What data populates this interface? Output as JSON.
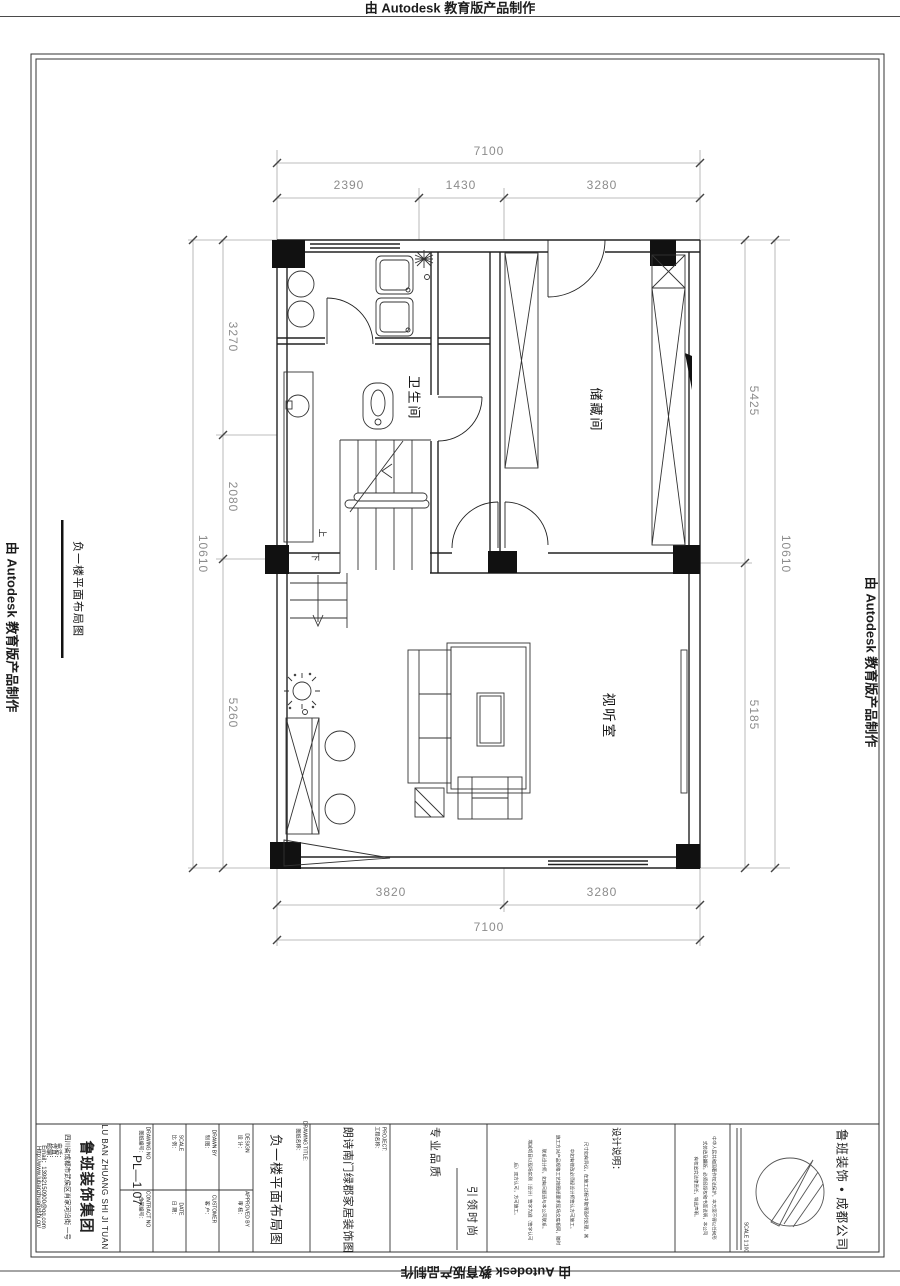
{
  "stamp": {
    "top": "由 Autodesk 教育版产品制作",
    "left": "由 Autodesk 教育版产品制作",
    "right": "由 Autodesk 教育版产品制作",
    "bottom": "由 Autodesk 教育版产品制作"
  },
  "plan": {
    "side_label": "负一楼平面布局图",
    "rooms": {
      "bathroom": "卫生间",
      "storage": "储藏间",
      "av": "视听室"
    },
    "stairs": {
      "up": "上",
      "down": "下"
    },
    "dims": {
      "top_total": "7100",
      "top_seg1": "2390",
      "top_seg2": "1430",
      "top_seg3": "3280",
      "left_seg1": "3270",
      "left_seg2": "2080",
      "left_seg3": "5260",
      "left_total": "10610",
      "right_seg1": "5425",
      "right_seg2": "5185",
      "right_total": "10610",
      "bottom_seg1": "3820",
      "bottom_seg2": "3280",
      "bottom_total": "7100"
    }
  },
  "titleblock": {
    "company_en": "LU BAN ZHUANG SHI JI TUAN",
    "company_cn": "鲁班装饰集团",
    "company_address": "四川省成都市武侯区肖家河沿街 一号",
    "contact_phone": "电话：",
    "contact_fax": "传真：",
    "contact_zip": "邮编：",
    "contact_email": "Email：13982150900@qq.com",
    "contact_web": "Http://www.lubanzhuangshi.cn/",
    "fields": {
      "drawing_no_en": "DRAWING NO",
      "drawing_no_cn": "图纸编号：",
      "drawing_no": "PL—1.07",
      "scale_en": "SCALE",
      "scale_cn": "比 例：",
      "drawn_en": "DRAWN BY",
      "drawn_cn": "制 图：",
      "design_en": "DESIGN",
      "design_cn": "设 计：",
      "contract_en": "CONTRACT NO",
      "contract_cn": "合同编号：",
      "date_en": "DATE",
      "date_cn": "日 期：",
      "customer_en": "CUSTOMER",
      "customer_cn": "客 户：",
      "approved_en": "APPROVED BY",
      "approved_cn": "审 核："
    },
    "drawing_title_en": "DRAWING TITLE:",
    "drawing_title_cn": "图纸名称：",
    "drawing_title": "负一楼平面布局图",
    "project_en": "PROJECT:",
    "project_cn": "工程名称：",
    "project": "朗诗南门绿郡家居装饰图",
    "slogan1": "专业品质",
    "slogan2": "引领时尚",
    "notes_title": "设计说明：",
    "notes": [
      "尺寸如有异议，在施工过程中取得及时处理，其",
      "中如有修改必须经设计师签认方可施工。",
      "施工方对产品规格工艺按图纸要求现场交底相同，随时",
      "联系设计师，如有问题请与本公司联系。",
      "增减项目以现场实测（设计）签字为准（签字认可",
      "后）双方认可，方可施工。"
    ],
    "copyright": [
      "中华人民共和国著作权法保护，本方案不得以任何形",
      "式仿造及翻版，必须经授权和书面说明，本公司",
      "有权追究法律责任，特此声明。"
    ],
    "scale_note": "SCALE 1:100",
    "brand": "鲁班装饰 • 成都公司"
  }
}
